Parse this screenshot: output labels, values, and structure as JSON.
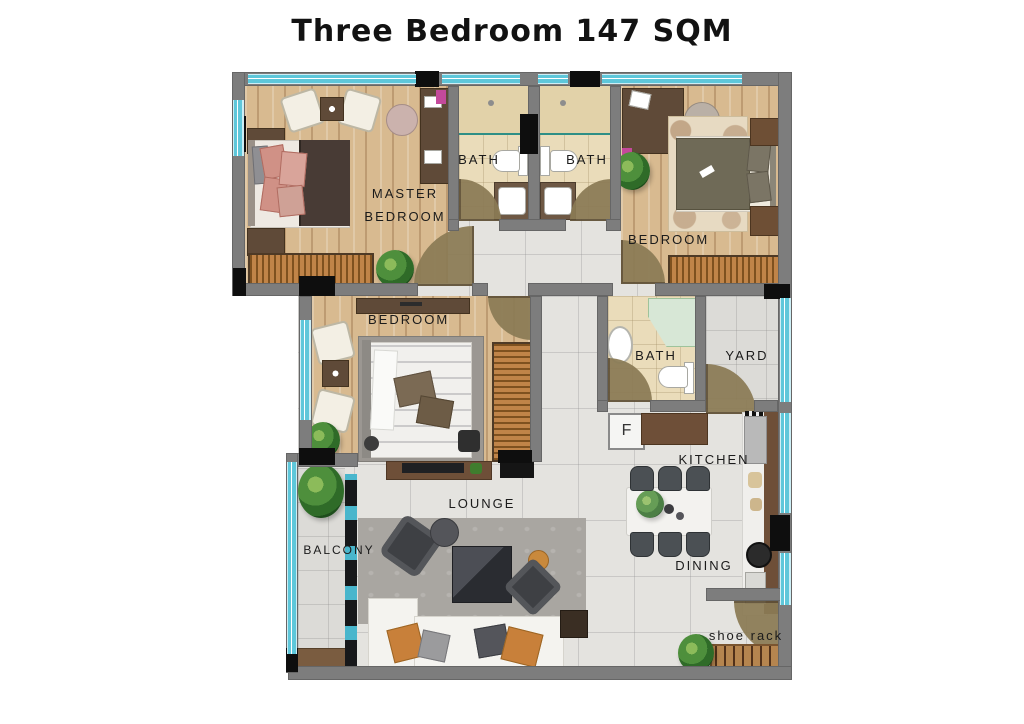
{
  "title": "Three Bedroom 147 SQM",
  "labels": {
    "master": "MASTER BEDROOM",
    "bath1": "BATH",
    "bath2": "BATH",
    "bedroom_right": "BEDROOM",
    "bedroom_left": "BEDROOM",
    "bath3": "BATH",
    "yard": "YARD",
    "kitchen": "KITCHEN",
    "dining": "DINING",
    "lounge": "LOUNGE",
    "balcony": "BALCONY",
    "fridge": "F",
    "shoe_rack": "shoe rack"
  },
  "colors": {
    "wall": "#7d7d7d",
    "column": "#0e0e0e",
    "window_glass": "#5ec7da",
    "door_swing": "#8b7b55",
    "wood_floor": "#d8ba90",
    "bath_tile": "#eadcba",
    "marble_tile": "#e4e3df",
    "wardrobe": "#c08448",
    "counter": "#6e4f38",
    "sofa": "#f4f3f0",
    "accent_orange": "#c8803a",
    "plant": "#4e8f3c"
  }
}
